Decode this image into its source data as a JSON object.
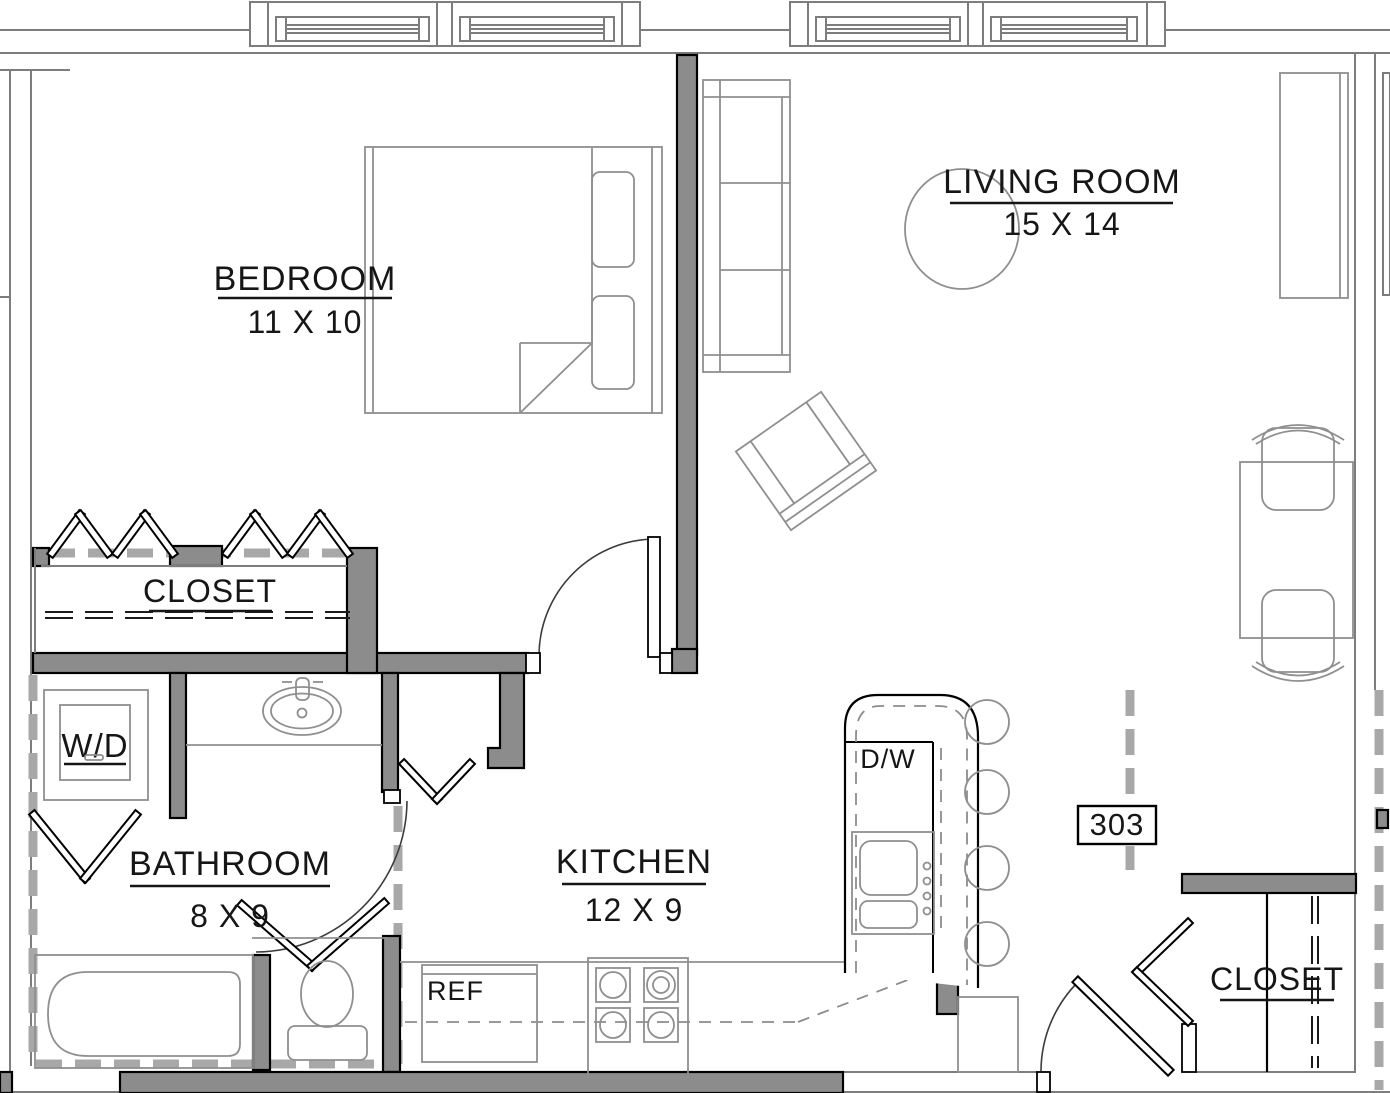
{
  "unit": {
    "number": "303"
  },
  "rooms": {
    "bedroom": {
      "label": "BEDROOM",
      "dims": "11 X 10"
    },
    "living_room": {
      "label": "LIVING ROOM",
      "dims": "15 X 14"
    },
    "closet": {
      "label": "CLOSET"
    },
    "bathroom": {
      "label": "BATHROOM",
      "dims": "8 X 9"
    },
    "kitchen": {
      "label": "KITCHEN",
      "dims": "12 X 9"
    },
    "entry_closet": {
      "label": "CLOSET"
    }
  },
  "appliances": {
    "washer_dryer": "W/D",
    "dishwasher": "D/W",
    "refrigerator": "REF"
  },
  "colors": {
    "background": "#ffffff",
    "wall_fill": "#8c8c8c",
    "wall_outline": "#000000",
    "furniture_line": "#8f8f8f",
    "dashed_wall": "#a8a8a8",
    "text": "#161616"
  }
}
